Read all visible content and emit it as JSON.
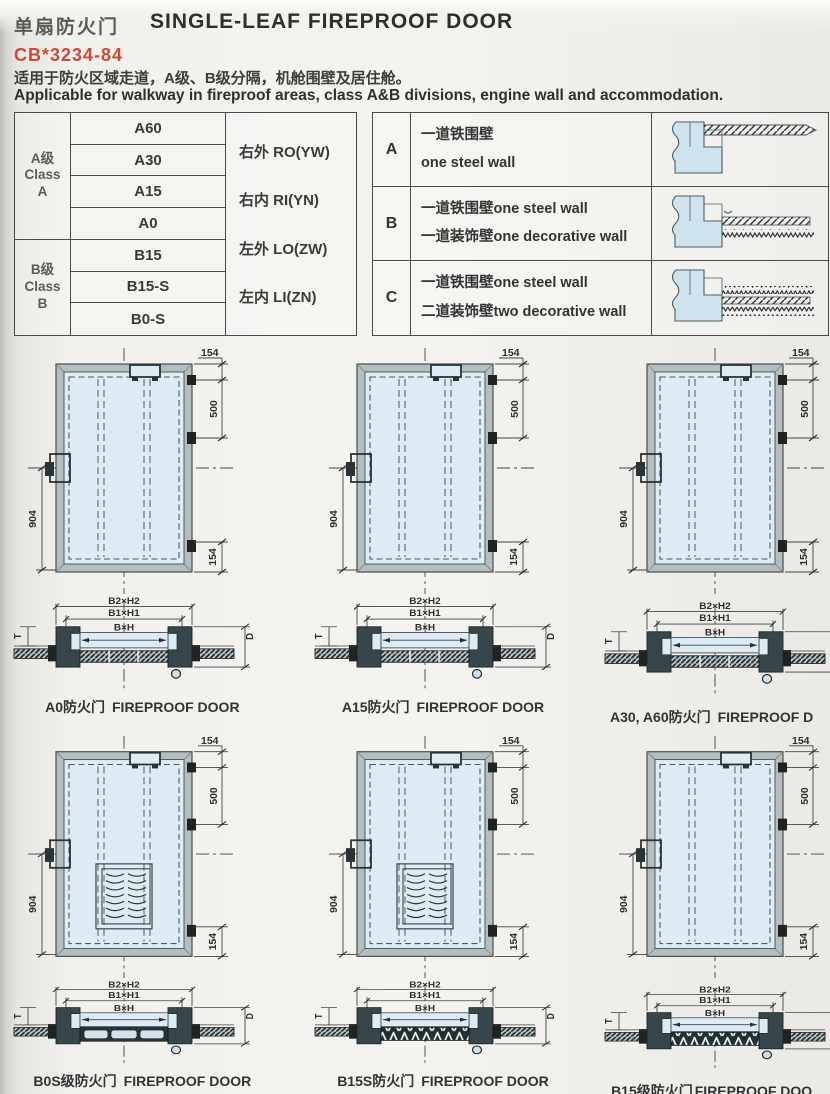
{
  "page": {
    "title_cn": "单扇防火门",
    "title_en": "SINGLE-LEAF FIREPROOF DOOR",
    "standard": "CB*3234-84",
    "desc_cn": "适用于防火区域走道，A级、B级分隔，机舱围壁及居住舱。",
    "desc_en": "Applicable for walkway in fireproof areas, class A&B divisions, engine wall and accommodation."
  },
  "class_table": {
    "group_a": {
      "line1": "A级",
      "line2": "Class",
      "line3": "A"
    },
    "group_b": {
      "line1": "B级",
      "line2": "Class",
      "line3": "B"
    },
    "ratings_a": [
      "A60",
      "A30",
      "A15",
      "A0"
    ],
    "ratings_b": [
      "B15",
      "B15-S",
      "B0-S"
    ],
    "orientations": [
      "右外 RO(YW)",
      "右内 RI(YN)",
      "左外 LO(ZW)",
      "左内 LI(ZN)"
    ]
  },
  "wall_table": {
    "rows": [
      {
        "key": "A",
        "line1": "一道铁围壁",
        "line2": "one steel wall"
      },
      {
        "key": "B",
        "line1": "一道铁围壁one steel wall",
        "line2": "一道装饰壁one decorative wall"
      },
      {
        "key": "C",
        "line1": "一道铁围壁one steel wall",
        "line2": "二道装饰壁two decorative wall"
      }
    ]
  },
  "door_dims": {
    "top": "154",
    "upper": "500",
    "height": "904",
    "bottom": "154"
  },
  "section_labels": {
    "outer": "B2×H2",
    "middle": "B1×H1",
    "inner": "B×H",
    "depth": "D",
    "thickness": "T"
  },
  "figures": [
    {
      "cn": "A0防火门",
      "en": "FIREPROOF DOOR"
    },
    {
      "cn": "A15防火门",
      "en": "FIREPROOF DOOR"
    },
    {
      "cn": "A30, A60防火门",
      "en": "FIREPROOF D"
    },
    {
      "cn": "B0S级防火门",
      "en": "FIREPROOF DOOR"
    },
    {
      "cn": "B15S防火门",
      "en": "FIREPROOF DOOR"
    },
    {
      "cn": "B15级防火门",
      "en": "FIREPROOF DOO"
    }
  ],
  "colors": {
    "accent_red": "#c84b38",
    "door_panel": "#dcebf4",
    "frame_gray": "#b2bec0",
    "line_dark": "#2c3537"
  }
}
